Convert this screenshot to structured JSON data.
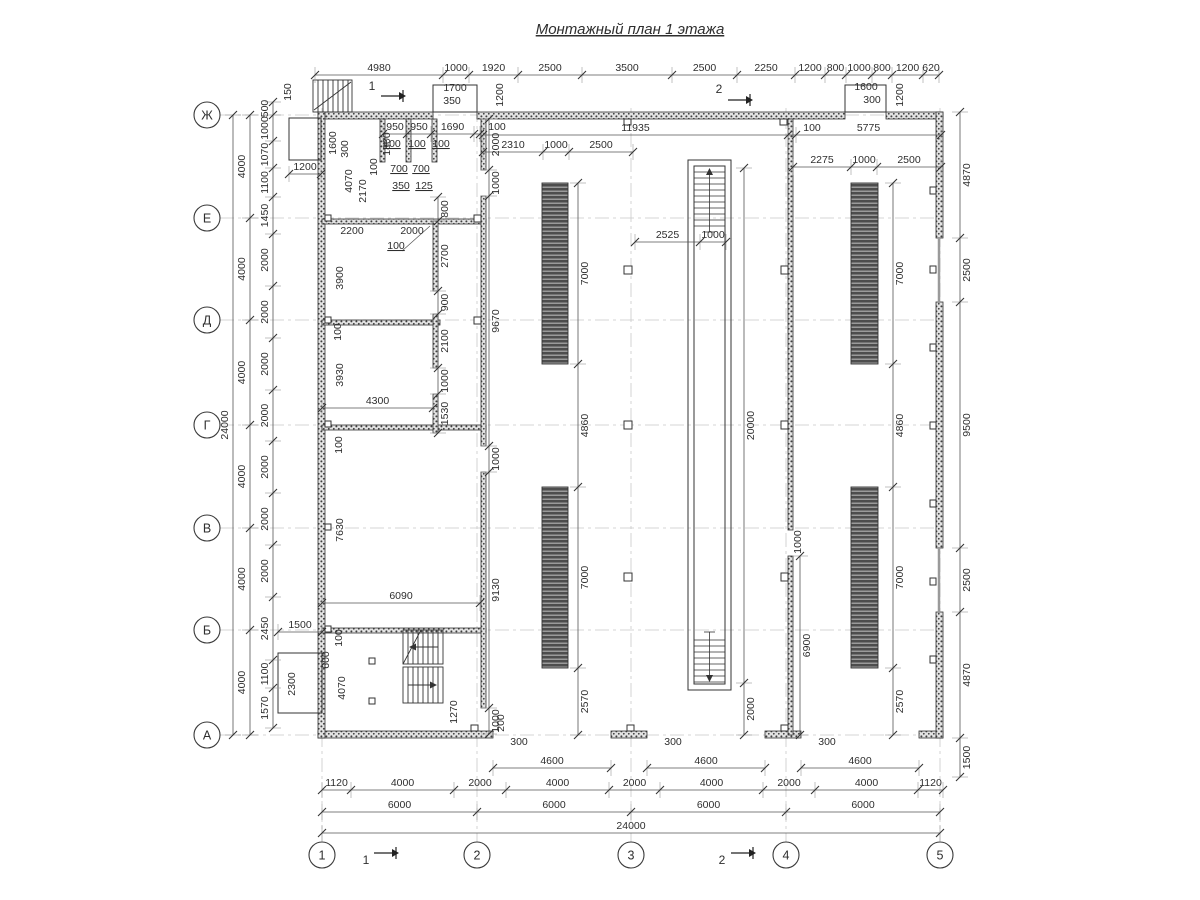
{
  "title": "Монтажный план 1 этажа",
  "colors": {
    "line": "#3a3a3a",
    "dim_line": "#555555",
    "light_axis": "#c9c9c9",
    "wall_dot": "#3f3f3f",
    "conveyor_dark": "#4d4d4d"
  },
  "axis_bubbles": {
    "left": [
      {
        "label": "Ж",
        "y": 115
      },
      {
        "label": "Е",
        "y": 218
      },
      {
        "label": "Д",
        "y": 320
      },
      {
        "label": "Г",
        "y": 425
      },
      {
        "label": "В",
        "y": 528
      },
      {
        "label": "Б",
        "y": 630
      },
      {
        "label": "А",
        "y": 735
      }
    ],
    "bottom": [
      {
        "label": "1",
        "x": 322
      },
      {
        "label": "2",
        "x": 477
      },
      {
        "label": "3",
        "x": 631
      },
      {
        "label": "4",
        "x": 786
      },
      {
        "label": "5",
        "x": 940
      }
    ]
  },
  "section_marks": [
    {
      "label": "1",
      "tx": 372,
      "ty": 90,
      "ax": 381,
      "ay": 96
    },
    {
      "label": "1",
      "tx": 366,
      "ty": 864,
      "ax": 374,
      "ay": 853
    },
    {
      "label": "2",
      "tx": 719,
      "ty": 93,
      "ax": 728,
      "ay": 100
    },
    {
      "label": "2",
      "tx": 722,
      "ty": 864,
      "ax": 731,
      "ay": 853
    }
  ],
  "chains": [
    {
      "o": "h",
      "pos": 75,
      "t": [
        315,
        443,
        469,
        518,
        582,
        672,
        737,
        795,
        825,
        846,
        872,
        892,
        923,
        939
      ],
      "l": [
        "4980",
        "1000",
        "1920",
        "2500",
        "3500",
        "2500",
        "2250",
        "1200",
        "800",
        "1000",
        "800",
        "1200",
        "620"
      ]
    },
    {
      "o": "h",
      "pos": 135,
      "t": [
        483,
        788,
        796,
        941
      ],
      "l": [
        "11935",
        {
          "t": "100",
          "at": 812
        },
        "5775"
      ]
    },
    {
      "o": "h",
      "pos": 152,
      "t": [
        483,
        543,
        569,
        633
      ],
      "l": [
        "2310",
        "1000",
        "2500"
      ]
    },
    {
      "o": "h",
      "pos": 167,
      "t": [
        793,
        851,
        877,
        941
      ],
      "l": [
        "2275",
        "1000",
        "2500"
      ]
    },
    {
      "o": "h",
      "pos": 242,
      "t": [
        635,
        700,
        726
      ],
      "l": [
        "2525",
        "1000"
      ]
    },
    {
      "o": "h",
      "pos": 134,
      "t": [
        383,
        407,
        431,
        474,
        480
      ],
      "l": [
        "950",
        "950",
        "1690",
        {
          "t": "100",
          "at": 497
        }
      ]
    },
    {
      "o": "h",
      "pos": 174,
      "t": [
        289,
        321
      ],
      "l": [
        "1200"
      ]
    },
    {
      "o": "h",
      "pos": 408,
      "t": [
        322,
        433
      ],
      "l": [
        "4300"
      ]
    },
    {
      "o": "h",
      "pos": 603,
      "t": [
        322,
        480
      ],
      "l": [
        "6090"
      ]
    },
    {
      "o": "h",
      "pos": 632,
      "t": [
        278,
        322
      ],
      "l": [
        "1500"
      ]
    },
    {
      "o": "h",
      "pos": 768,
      "t": [
        493,
        611
      ],
      "l": [
        "4600"
      ]
    },
    {
      "o": "h",
      "pos": 768,
      "t": [
        647,
        765
      ],
      "l": [
        "4600"
      ]
    },
    {
      "o": "h",
      "pos": 768,
      "t": [
        801,
        919
      ],
      "l": [
        "4600"
      ]
    },
    {
      "o": "h",
      "pos": 790,
      "t": [
        322,
        351,
        454,
        506,
        609,
        660,
        763,
        815,
        918,
        943
      ],
      "l": [
        "1120",
        "4000",
        "2000",
        "4000",
        "2000",
        "4000",
        "2000",
        "4000",
        "1120"
      ]
    },
    {
      "o": "h",
      "pos": 812,
      "t": [
        322,
        477,
        631,
        786,
        940
      ],
      "l": [
        "6000",
        "6000",
        "6000",
        "6000"
      ]
    },
    {
      "o": "h",
      "pos": 833,
      "t": [
        322,
        940
      ],
      "l": [
        "24000"
      ]
    },
    {
      "o": "v",
      "pos": 273,
      "s": -1,
      "t": [
        102,
        115,
        141,
        168,
        197,
        234,
        286,
        338,
        390,
        441,
        493,
        545,
        597,
        660,
        688,
        728
      ],
      "l": [
        "500",
        "1000",
        "1070",
        "1100",
        "1450",
        "2000",
        "2000",
        "2000",
        "2000",
        "2000",
        "2000",
        "2000",
        "2450",
        "1100",
        "1570"
      ]
    },
    {
      "o": "v",
      "pos": 250,
      "s": -1,
      "t": [
        115,
        218,
        320,
        425,
        528,
        630,
        735
      ],
      "l": [
        "4000",
        "4000",
        "4000",
        "4000",
        "4000",
        "4000"
      ]
    },
    {
      "o": "v",
      "pos": 233,
      "s": -1,
      "t": [
        115,
        735
      ],
      "l": [
        "24000"
      ]
    },
    {
      "o": "v",
      "pos": 960,
      "s": 1,
      "t": [
        112,
        238,
        302,
        548,
        612,
        738,
        777
      ],
      "l": [
        "4870",
        "2500",
        "9500",
        "2500",
        "4870",
        "1500"
      ]
    },
    {
      "o": "v",
      "pos": 578,
      "s": 1,
      "t": [
        183,
        364,
        487,
        668,
        735
      ],
      "l": [
        "7000",
        "4860",
        "7000",
        "2570"
      ]
    },
    {
      "o": "v",
      "pos": 893,
      "s": 1,
      "t": [
        183,
        364,
        487,
        668,
        735
      ],
      "l": [
        "7000",
        "4860",
        "7000",
        "2570"
      ]
    },
    {
      "o": "v",
      "pos": 744,
      "s": 1,
      "t": [
        168,
        683,
        735
      ],
      "l": [
        "20000",
        "2000"
      ]
    },
    {
      "o": "v",
      "pos": 800,
      "s": 1,
      "t": [
        556,
        735
      ],
      "l": [
        "6900"
      ]
    },
    {
      "o": "v",
      "pos": 489,
      "s": 1,
      "t": [
        119,
        170,
        196,
        446,
        472,
        708,
        734
      ],
      "l": [
        "2000",
        "1000",
        "9670",
        "1000",
        "9130",
        "1000"
      ]
    },
    {
      "o": "v",
      "pos": 438,
      "s": 1,
      "t": [
        197,
        221,
        291,
        314,
        368,
        394,
        433
      ],
      "l": [
        "800",
        "2700",
        "900",
        "2100",
        "1000",
        "1530"
      ]
    }
  ],
  "free_labels": [
    {
      "t": "1700",
      "x": 455,
      "y": 91
    },
    {
      "t": "350",
      "x": 452,
      "y": 104
    },
    {
      "t": "1200",
      "x": 503,
      "y": 95,
      "r": 1
    },
    {
      "t": "1600",
      "x": 866,
      "y": 90
    },
    {
      "t": "300",
      "x": 872,
      "y": 103
    },
    {
      "t": "1200",
      "x": 903,
      "y": 95,
      "r": 1
    },
    {
      "t": "150",
      "x": 291,
      "y": 92,
      "r": 1
    },
    {
      "t": "1600",
      "x": 336,
      "y": 143,
      "r": 1
    },
    {
      "t": "300",
      "x": 348,
      "y": 149,
      "r": 1
    },
    {
      "t": "4070",
      "x": 352,
      "y": 181,
      "r": 1
    },
    {
      "t": "2170",
      "x": 366,
      "y": 191,
      "r": 1
    },
    {
      "t": "100",
      "x": 377,
      "y": 167,
      "r": 1
    },
    {
      "t": "1800",
      "x": 390,
      "y": 144,
      "r": 1
    },
    {
      "t": "700",
      "x": 399,
      "y": 172,
      "u": 1
    },
    {
      "t": "700",
      "x": 421,
      "y": 172,
      "u": 1
    },
    {
      "t": "350",
      "x": 401,
      "y": 189,
      "u": 1
    },
    {
      "t": "125",
      "x": 424,
      "y": 189,
      "u": 1
    },
    {
      "t": "100",
      "x": 392,
      "y": 147,
      "u": 1
    },
    {
      "t": "100",
      "x": 417,
      "y": 147,
      "u": 1
    },
    {
      "t": "100",
      "x": 441,
      "y": 147,
      "u": 1
    },
    {
      "t": "2200",
      "x": 352,
      "y": 234
    },
    {
      "t": "2000",
      "x": 412,
      "y": 234
    },
    {
      "t": "100",
      "x": 396,
      "y": 249,
      "u": 1
    },
    {
      "t": "3900",
      "x": 343,
      "y": 278,
      "r": 1
    },
    {
      "t": "3930",
      "x": 343,
      "y": 375,
      "r": 1
    },
    {
      "t": "100",
      "x": 341,
      "y": 332,
      "r": 1
    },
    {
      "t": "100",
      "x": 342,
      "y": 445,
      "r": 1
    },
    {
      "t": "100",
      "x": 342,
      "y": 638,
      "r": 1
    },
    {
      "t": "7630",
      "x": 343,
      "y": 530,
      "r": 1
    },
    {
      "t": "4070",
      "x": 345,
      "y": 688,
      "r": 1
    },
    {
      "t": "1270",
      "x": 457,
      "y": 712,
      "r": 1
    },
    {
      "t": "200",
      "x": 504,
      "y": 723,
      "r": 1
    },
    {
      "t": "600",
      "x": 329,
      "y": 660,
      "r": 1
    },
    {
      "t": "2300",
      "x": 295,
      "y": 684,
      "r": 1
    },
    {
      "t": "1000",
      "x": 801,
      "y": 542,
      "r": 1
    },
    {
      "t": "300",
      "x": 519,
      "y": 745
    },
    {
      "t": "300",
      "x": 673,
      "y": 745
    },
    {
      "t": "300",
      "x": 827,
      "y": 745
    }
  ]
}
